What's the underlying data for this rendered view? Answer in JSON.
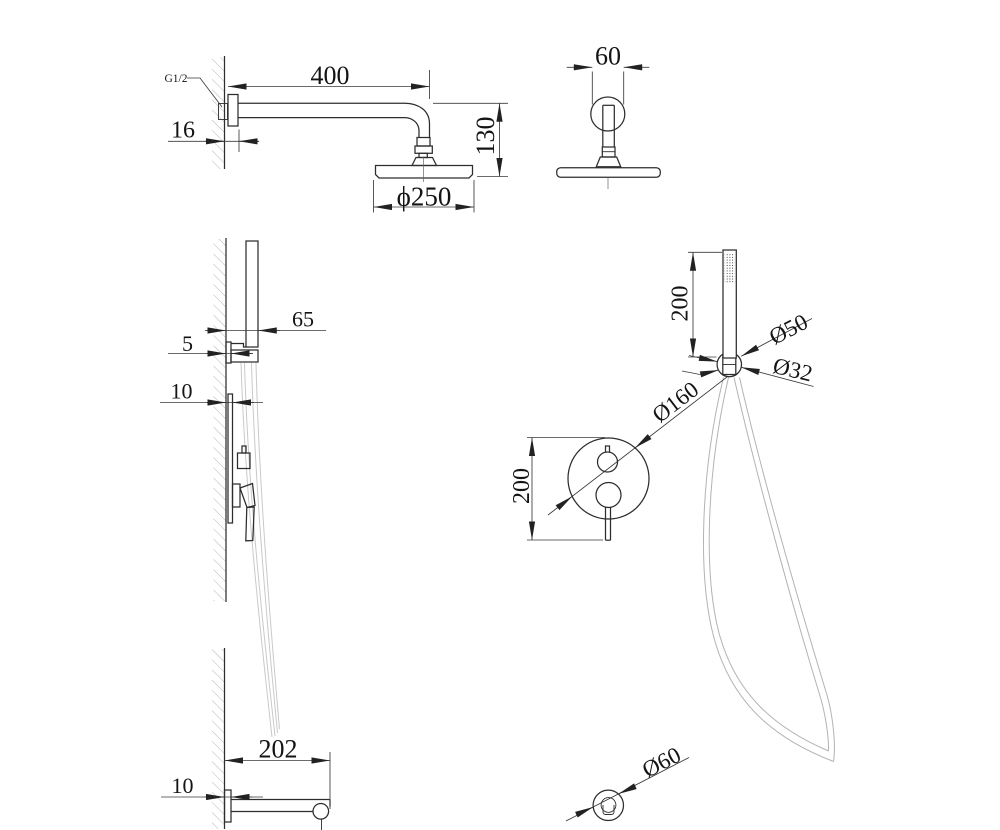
{
  "labels": {
    "thread_size": "G1/2",
    "arm_length": "400",
    "arm_plate_depth": "16",
    "head_drop": "130",
    "head_diameter": "ϕ250",
    "arm_plate_width": "60",
    "holder_offset": "65",
    "holder_plate_depth": "5",
    "valve_plate_depth": "10",
    "handshower_length": "200",
    "handshower_diameter": "Ø50",
    "hose_nut_diameter": "Ø32",
    "valve_plate_diameter": "Ø160",
    "valve_plate_height": "200",
    "spout_length": "202",
    "spout_plate_depth": "10",
    "outlet_diameter": "Ø60"
  },
  "colors": {
    "object_line": "#2d2d2d",
    "dimension_line": "#3a3a3a",
    "wall_hatch": "#a5a5a5",
    "hose_light": "#c9c9c9",
    "text": "#141414",
    "background": "#ffffff"
  }
}
